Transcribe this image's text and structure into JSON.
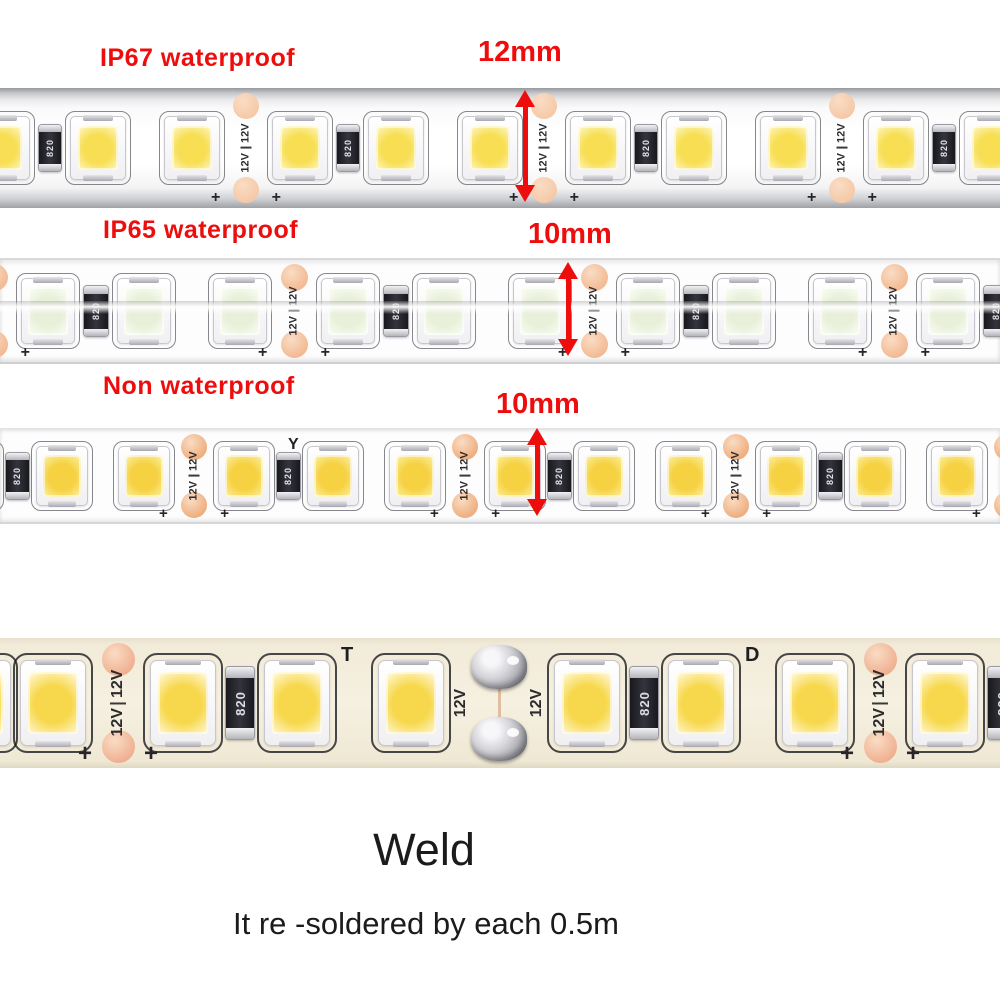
{
  "colors": {
    "annotation_red": "#ee0d0d",
    "caption_dark": "#1b1b1b",
    "copper_pad": "#f2bb95",
    "pcb_white": "#fdfdfe",
    "pcb_cream": "#f2ebd9",
    "tube_gray": "#b9babe",
    "solder_silver": "#c9c9cd",
    "led_warm": "#f7d84d",
    "led_cool": "#e8f0da"
  },
  "annotations": {
    "strip1": {
      "label": "IP67 waterproof",
      "size": "12mm"
    },
    "strip2": {
      "label": "IP65 waterproof",
      "size": "10mm"
    },
    "strip3": {
      "label": "Non waterproof",
      "size": "10mm"
    }
  },
  "footer": {
    "title": "Weld",
    "subtitle": "It re -soldered by each 0.5m"
  },
  "component_text": {
    "voltage": "12V",
    "resistor_code": "820",
    "plus_mark": "+",
    "mark_t": "T",
    "mark_d": "D",
    "mark_y": "Y"
  },
  "strips": [
    {
      "id": "strip-ip67",
      "top": 88,
      "height": 120,
      "led_w": 54,
      "led_h": 62,
      "chip_w": 40,
      "chip_h": 44,
      "chip_center": "#f7de52",
      "chip_edge": "#fcf0a6",
      "pad_size": 26,
      "pad_color": "#f5c9a7",
      "res_w": 22,
      "res_h": 46,
      "gap_w": 22,
      "cut_w": 36,
      "col_gap": 8,
      "sections": 5,
      "offset": -70,
      "v_font": 11,
      "r_font": 9,
      "p_font": 16,
      "marks": []
    },
    {
      "id": "strip-ip65",
      "top": 258,
      "height": 102,
      "led_w": 52,
      "led_h": 64,
      "chip_w": 40,
      "chip_h": 48,
      "chip_center": "#e8f0da",
      "chip_edge": "#f7faef",
      "pad_size": 27,
      "pad_color": "#f2ba93",
      "res_w": 24,
      "res_h": 50,
      "gap_w": 26,
      "cut_w": 38,
      "col_gap": 8,
      "sections": 5,
      "offset": -25,
      "v_font": 11,
      "r_font": 9,
      "p_font": 16,
      "marks": []
    },
    {
      "id": "strip-non",
      "top": 428,
      "height": 92,
      "led_w": 50,
      "led_h": 58,
      "chip_w": 38,
      "chip_h": 42,
      "chip_center": "#f6d243",
      "chip_edge": "#fae88c",
      "pad_size": 26,
      "pad_color": "#eeae7e",
      "res_w": 23,
      "res_h": 46,
      "gap_w": 18,
      "cut_w": 36,
      "col_gap": 6,
      "sections": 5,
      "offset": -95,
      "v_font": 11,
      "r_font": 9,
      "p_font": 15,
      "marks": [
        {
          "t": "mark_y",
          "x": 288,
          "y": 6,
          "size": 16
        }
      ]
    },
    {
      "id": "strip-weld",
      "top": 638,
      "height": 130,
      "led_w": 64,
      "led_h": 84,
      "chip_w": 50,
      "chip_h": 62,
      "chip_center": "#f7d84d",
      "chip_edge": "#fdf0b4",
      "pad_size": 33,
      "pad_color": "#efb091",
      "res_w": 28,
      "res_h": 72,
      "gap_w": 30,
      "cut_w": 46,
      "col_gap": 9,
      "joint_w": 92,
      "offset": -55,
      "v_font": 16,
      "r_font": 13,
      "p_font": 24,
      "seq": [
        "L",
        "L",
        "C",
        "L",
        "R",
        "L",
        "GT",
        "L",
        "J",
        "L",
        "R",
        "L",
        "GD",
        "L",
        "C",
        "L",
        "R",
        "L"
      ],
      "marks": []
    }
  ]
}
